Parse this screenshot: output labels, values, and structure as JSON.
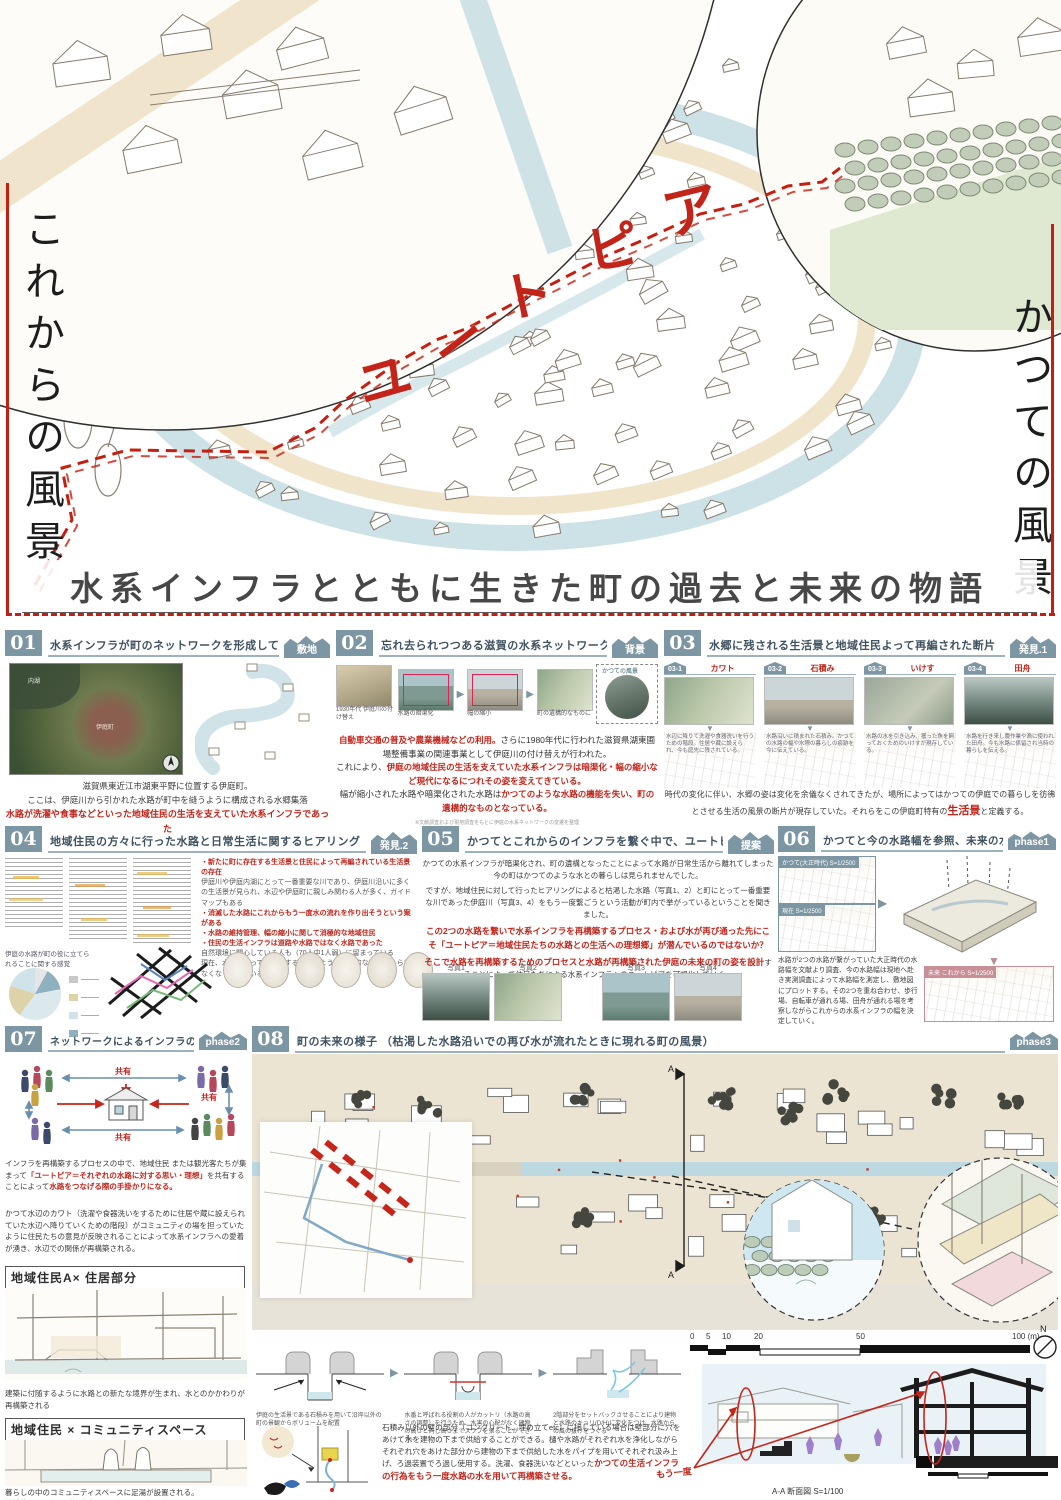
{
  "poster": {
    "main_title": "水系インフラとともに生きた町の過去と未来の物語",
    "left_vertical_title": "これからの風景",
    "right_vertical_title": "かつての風景",
    "utopia": {
      "c0": "ユ",
      "c1": "ー",
      "c2": "ト",
      "c3": "ピ",
      "c4": "ア"
    },
    "accent_red": "#c2241a",
    "slate": "#7d96a4"
  },
  "s01": {
    "number": "01",
    "tag": "敷地",
    "title": "水系インフラが町のネットワークを形成していた町",
    "map_labels": {
      "lake": "内湖",
      "town": "伊庭町"
    },
    "caption1": "滋賀県東近江市湖東平野に位置する伊庭町。",
    "caption2": "ここは、伊庭川から引かれた水路が町中を縫うように構成される水郷集落",
    "caption3": "水路が洗濯や食事などといった地域住民の生活を支えていた水系インフラであった"
  },
  "s02": {
    "number": "02",
    "tag": "背景",
    "title": "忘れ去られつつある滋賀の水系ネットワーク",
    "photo_captions": [
      "1930年代 伊庭川の付け替え",
      "水路の暗渠化",
      "幅の縮小",
      "町の遺構的なものに"
    ],
    "circle_label": "かつての風景",
    "p1_red": "自動車交通の普及や農業機械などの利用。",
    "p1": "さらに1980年代に行われた滋賀県湖東圃場整備事業の関連事業として伊庭川の付け替えが行われた。",
    "p2": "これにより、",
    "p2_red": "伊庭の地域住民の生活を支えていた水系インフラは暗渠化・幅の縮小など現代になるにつれその姿を変えてきている。",
    "p3": "幅が縮小された水路や暗渠化された水路は",
    "p3_red": "かつてのような水路の機能を失い、町の遺構的なものとなっている。",
    "footnote": "※文献調査および現地調査をもとに伊庭の水系ネットワークの変遷を整理"
  },
  "s03": {
    "number": "03",
    "tag": "発見.1",
    "title": "水郷に残される生活景と地域住民よって再編された断片",
    "items": [
      {
        "id": "03-1",
        "label": "カワト",
        "desc": "水辺に降りて洗濯や食器洗いを行うための階段。住居や蔵に設えられ、今も庭先に残されている。"
      },
      {
        "id": "03-2",
        "label": "石積み",
        "desc": "水路沿いに積まれた石積み。かつての水路の幅や水際の暮らしの痕跡を今に伝えている。"
      },
      {
        "id": "03-3",
        "label": "いけす",
        "desc": "水路の水を引き込み、獲った魚を飼っておくためのいけすが現存している。"
      },
      {
        "id": "03-4",
        "label": "田舟",
        "desc": "水路を行き来し農作業や漁に使われた田舟。今も水路に係留され当時の暮らしを伝える。"
      }
    ],
    "p_before": "時代の変化に伴い、水郷の姿は変化を余儀なくされてきたが、場所によってはかつての伊庭での暮らしを彷彿とさせる生活の風景の断片が現存していた。それらをこの伊庭町特有の",
    "p_red": "生活景",
    "p_after": "と定義する。"
  },
  "s04": {
    "number": "04",
    "tag": "発見.2",
    "title": "地域住民の方々に行った水路と日常生活に関するヒアリング",
    "bullets": [
      {
        "text": "新たに町に存在する生活景と住民によって再編されている生活景の存在"
      },
      {
        "text": "伊庭川や伊庭内湖にとって一番重要な川であり、伊庭川沿いに多くの生活景が見られ、水辺や伊庭町に親しみ関わる人が多く、ガイドマップもある"
      },
      {
        "text": "消滅した水路にこれからもう一度水の流れを作り出そうという案がある"
      },
      {
        "text": "水路の維持管理、幅の縮小に関して消極的な地域住民"
      },
      {
        "text": "住民の生活インフラは道路や水路ではなく水路であった"
      },
      {
        "text": "自然環境に関心している人も（70人中1人弱）に留まっている"
      },
      {
        "text": "現在、水路を使って何かをするというような日常的な行動がみられなくなってきている"
      }
    ],
    "pie_caption1": "伊庭の水路が町の役に立てら",
    "pie_caption2": "れることに関する感覚"
  },
  "s05": {
    "number": "05",
    "tag": "提案",
    "title": "かつてとこれからのインフラを繋ぐ中で、ユートピアを獲得",
    "p1": "かつての水系インフラが暗渠化され、町の遺構となったことによって水路が日常生活から離れてしまった今の町はかつてのような水との暮らしは見られませんでした。",
    "p2": "ですが、地域住民に対して行ったヒアリングによると枯渇した水路（写真1、2）と町にとって一番重要な川であった伊庭川（写真3、4）をもう一度繋ごうという活動が町内で挙がっているということを聞きました。",
    "p3_red": "この2つの水路を繋いで水系インフラを再構築するプロセス・および水が再び通った先にこそ「ユートピア＝地域住民たちの水路との生活への理想郷」が潜んでいるのではないか？",
    "p4_red": "そこで水路を再構築するためのプロセスと水路が再構築された伊庭の未来の町の姿を設計",
    "p4": "することによって住民たちによる水系インフラへのユートピアを可視化していく。",
    "photo_labels": [
      "写真1",
      "写真2",
      "写真3",
      "写真4"
    ]
  },
  "s06": {
    "number": "06",
    "tag": "phase1",
    "title": "かつてと今の水路幅を参照、未来の水路幅を決定",
    "map_label_top": "かつて(大正時代) S=1/2500",
    "map_label_mid": "現在 S=1/2500",
    "map_label_bottom": "未来 これから S=1/2500",
    "p": "水路が2つの水路が繋がっていた大正時代の水路幅を文献より調査、今の水路幅は現地へ赴き実測調査によって水路幅を測定し、敷地図にプロットする。その2つを重ね合わせ、歩行場、自転車が通れる場、田舟が通れる場を考察しながらこれからの水系インフラの幅を決定していく。"
  },
  "s07": {
    "number": "07",
    "tag": "phase2",
    "title": "ネットワークによるインフラの再構築",
    "share_label": "共有",
    "p1a": "インフラを再構築するプロセスの中で、地域住民 または観光客たちが集まって",
    "p1_red": "「ユートピア＝それぞれの水路に対する思い・理想」",
    "p1b": "を共有することによって",
    "p1_red2": "水路をつなげる際の手掛かりになる。",
    "p2": "かつて水辺のカワト（洗濯や食器洗いをするために住居や蔵に設えられていた水辺へ降りていくための階段）がコミュニティの場を担っていたように住民たちの意見が反映されることによって水系インフラへの愛着が湧き、水辺での関係が再構築される。",
    "box1": "地域住民A× 住居部分",
    "mid_text": "建築に付随するように水路との新たな境界が生まれ、水とのかかわりが再構築される",
    "box2": "地域住民 × コミュニティスペース",
    "bottom1": "暮らしの中のコミュニティスペースに足湯が設置される。",
    "bottom2": "地域住民のみならず観光客とのふれあいの場になる"
  },
  "s08": {
    "number": "08",
    "tag": "phase3",
    "title": "町の未来の様子 （枯渇した水路沿いでの再び水が流れたときに現れる町の風景）",
    "marker_a": "A",
    "scale_ticks": [
      "0",
      "5",
      "10",
      "20",
      "50",
      "100 (m)"
    ],
    "north": "N",
    "diagrams": [
      {
        "caption": "伊庭の生活景である石積みを用いて沿岸以外の町の景観からボリュームを配置"
      },
      {
        "caption": "水番と呼ばれる役割の人がカットリ（水路の高さの調整）を行うため、水害の心配がなく建物の高さと同じ高さまでスラブを張ることができる。"
      },
      {
        "caption": "2階部分をセットバックさせることにより建物と水路のキョリ(D/H)に変化をつけ、水路からの風の抜けをつくる"
      }
    ],
    "p": "石積み以外の壁の部分（コンクリート、埋め立てetc）に接している場合は壁部分に穴をあけて水を建物の下まで供給することができる。樋や水路がそれぞれ水を浄化しながらそれぞれ穴をあけた部分から建物の下まで供給した水をパイプを用いてそれぞれ汲み上げ、ろ過装置でろ過し使用する。洗濯、食器洗いなどといった",
    "p_red": "かつての生活インフラの行為をもう一度水路の水を用いて再構築させる。",
    "section_caption": "A-A 断面図 S=1/100",
    "annotation_red": "もう一度"
  }
}
